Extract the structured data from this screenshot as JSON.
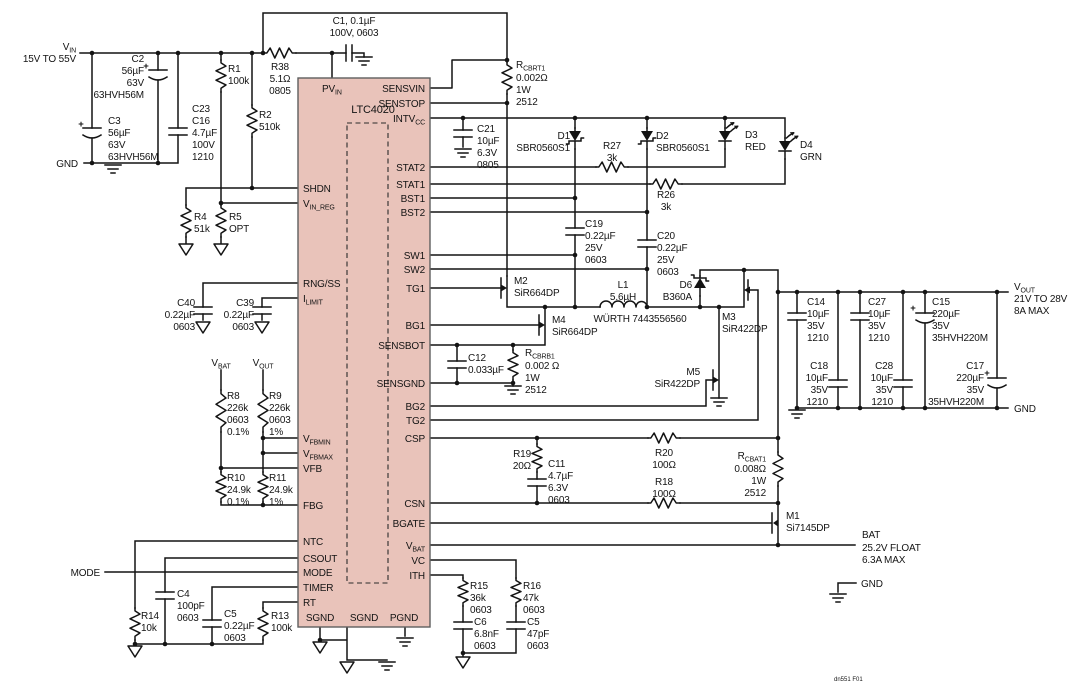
{
  "colors": {
    "ic_fill": "#e9c3ba",
    "wire": "#141414",
    "footer_text": "#b4b4b8"
  },
  "terminals": {
    "vin": {
      "m": "V",
      "s": "IN",
      "range": "15V TO 55V"
    },
    "gnd_in": "GND",
    "mode": "MODE",
    "vout": {
      "m": "V",
      "s": "OUT",
      "lines": [
        "21V TO 28V",
        "8A MAX"
      ]
    },
    "gnd_out": "GND",
    "bat": {
      "name": "BAT",
      "lines": [
        "25.2V FLOAT",
        "6.3A MAX"
      ]
    },
    "gnd_bat": "GND",
    "vbat_div": {
      "m": "V",
      "s": "BAT"
    },
    "vout_div": {
      "m": "V",
      "s": "OUT"
    },
    "footer": "dn551 F01"
  },
  "ic": {
    "name": "LTC4020",
    "top": {
      "m": "PV",
      "s": "IN"
    },
    "left": [
      {
        "m": "SHDN",
        "s": ""
      },
      {
        "m": "V",
        "s": "IN_REG"
      },
      {
        "m": "RNG/SS",
        "s": ""
      },
      {
        "m": "I",
        "s": "LIMIT"
      },
      {
        "m": "V",
        "s": "FBMIN"
      },
      {
        "m": "V",
        "s": "FBMAX"
      },
      {
        "m": "VFB",
        "s": ""
      },
      {
        "m": "FBG",
        "s": ""
      },
      {
        "m": "NTC",
        "s": ""
      },
      {
        "m": "CSOUT",
        "s": ""
      },
      {
        "m": "MODE",
        "s": ""
      },
      {
        "m": "TIMER",
        "s": ""
      },
      {
        "m": "RT",
        "s": ""
      }
    ],
    "right": [
      {
        "m": "SENSVIN",
        "s": ""
      },
      {
        "m": "SENSTOP",
        "s": ""
      },
      {
        "m": "INTV",
        "s": "CC"
      },
      {
        "m": "STAT2",
        "s": ""
      },
      {
        "m": "STAT1",
        "s": ""
      },
      {
        "m": "BST1",
        "s": ""
      },
      {
        "m": "BST2",
        "s": ""
      },
      {
        "m": "SW1",
        "s": ""
      },
      {
        "m": "SW2",
        "s": ""
      },
      {
        "m": "TG1",
        "s": ""
      },
      {
        "m": "BG1",
        "s": ""
      },
      {
        "m": "SENSBOT",
        "s": ""
      },
      {
        "m": "SENSGND",
        "s": ""
      },
      {
        "m": "BG2",
        "s": ""
      },
      {
        "m": "TG2",
        "s": ""
      },
      {
        "m": "CSP",
        "s": ""
      },
      {
        "m": "CSN",
        "s": ""
      },
      {
        "m": "BGATE",
        "s": ""
      },
      {
        "m": "V",
        "s": "BAT"
      },
      {
        "m": "VC",
        "s": ""
      },
      {
        "m": "ITH",
        "s": ""
      }
    ],
    "bottom": [
      "SGND",
      "SGND",
      "PGND"
    ]
  },
  "components": {
    "r1": [
      "R1",
      "100k"
    ],
    "r2": [
      "R2",
      "510k"
    ],
    "r4": [
      "R4",
      "51k"
    ],
    "r5": [
      "R5",
      "OPT"
    ],
    "r38": [
      "R38",
      "5.1Ω",
      "0805"
    ],
    "c1": [
      "C1, 0.1µF",
      "100V, 0603"
    ],
    "c2": [
      "C2",
      "56µF",
      "63V",
      "63HVH56M"
    ],
    "c3": [
      "C3",
      "56µF",
      "63V",
      "63HVH56M"
    ],
    "c23": [
      "C23",
      "C16",
      "4.7µF",
      "100V",
      "1210"
    ],
    "rcbrt1": {
      "m": "R",
      "s": "CBRT1",
      "lines": [
        "0.002Ω",
        "1W",
        "2512"
      ]
    },
    "c21": [
      "C21",
      "10µF",
      "6.3V",
      "0805"
    ],
    "d1": [
      "D1",
      "SBR0560S1"
    ],
    "d2": [
      "D2",
      "SBR0560S1"
    ],
    "d3": [
      "D3",
      "RED"
    ],
    "d4": [
      "D4",
      "GRN"
    ],
    "r27": [
      "R27",
      "3k"
    ],
    "r26": [
      "R26",
      "3k"
    ],
    "c19": [
      "C19",
      "0.22µF",
      "25V",
      "0603"
    ],
    "c20": [
      "C20",
      "0.22µF",
      "25V",
      "0603"
    ],
    "m2": [
      "M2",
      "SiR664DP"
    ],
    "m4": [
      "M4",
      "SiR664DP"
    ],
    "m3": [
      "M3",
      "SiR422DP"
    ],
    "m5": [
      "M5",
      "SiR422DP"
    ],
    "m1": [
      "M1",
      "Si7145DP"
    ],
    "d6": [
      "D6",
      "B360A"
    ],
    "l1": [
      "L1",
      "5.6µH"
    ],
    "l1_part": "WÜRTH 7443556560",
    "c12": [
      "C12",
      "0.033µF"
    ],
    "rcbrb1": {
      "m": "R",
      "s": "CBRB1",
      "lines": [
        "0.002 Ω",
        "1W",
        "2512"
      ]
    },
    "c40": [
      "C40",
      "0.22µF",
      "0603"
    ],
    "c39": [
      "C39",
      "0.22µF",
      "0603"
    ],
    "r8": [
      "R8",
      "226k",
      "0603",
      "0.1%"
    ],
    "r9": [
      "R9",
      "226k",
      "0603",
      "1%"
    ],
    "r10": [
      "R10",
      "24.9k",
      "0.1%"
    ],
    "r11": [
      "R11",
      "24.9k",
      "1%"
    ],
    "r19": [
      "R19",
      "20Ω"
    ],
    "c11": [
      "C11",
      "4.7µF",
      "6.3V",
      "0603"
    ],
    "r20": [
      "R20",
      "100Ω"
    ],
    "r18": [
      "R18",
      "100Ω"
    ],
    "rcbat1": {
      "m": "R",
      "s": "CBAT1",
      "lines": [
        "0.008Ω",
        "1W",
        "2512"
      ]
    },
    "r14": [
      "R14",
      "10k"
    ],
    "c4": [
      "C4",
      "100pF",
      "0603"
    ],
    "c5": [
      "C5",
      "0.22µF",
      "0603"
    ],
    "r13": [
      "R13",
      "100k"
    ],
    "r15": [
      "R15",
      "36k",
      "0603"
    ],
    "c6": [
      "C6",
      "6.8nF",
      "0603"
    ],
    "r16": [
      "R16",
      "47k",
      "0603"
    ],
    "c5b": [
      "C5",
      "47pF",
      "0603"
    ],
    "c14": [
      "C14",
      "10µF",
      "35V",
      "1210"
    ],
    "c27": [
      "C27",
      "10µF",
      "35V",
      "1210"
    ],
    "c15": [
      "C15",
      "220µF",
      "35V",
      "35HVH220M"
    ],
    "c18": [
      "C18",
      "10µF",
      "35V",
      "1210"
    ],
    "c28": [
      "C28",
      "10µF",
      "35V",
      "1210"
    ],
    "c17": [
      "C17",
      "220µF",
      "35V",
      "35HVH220M"
    ]
  },
  "misc": {
    "plus": "+"
  }
}
